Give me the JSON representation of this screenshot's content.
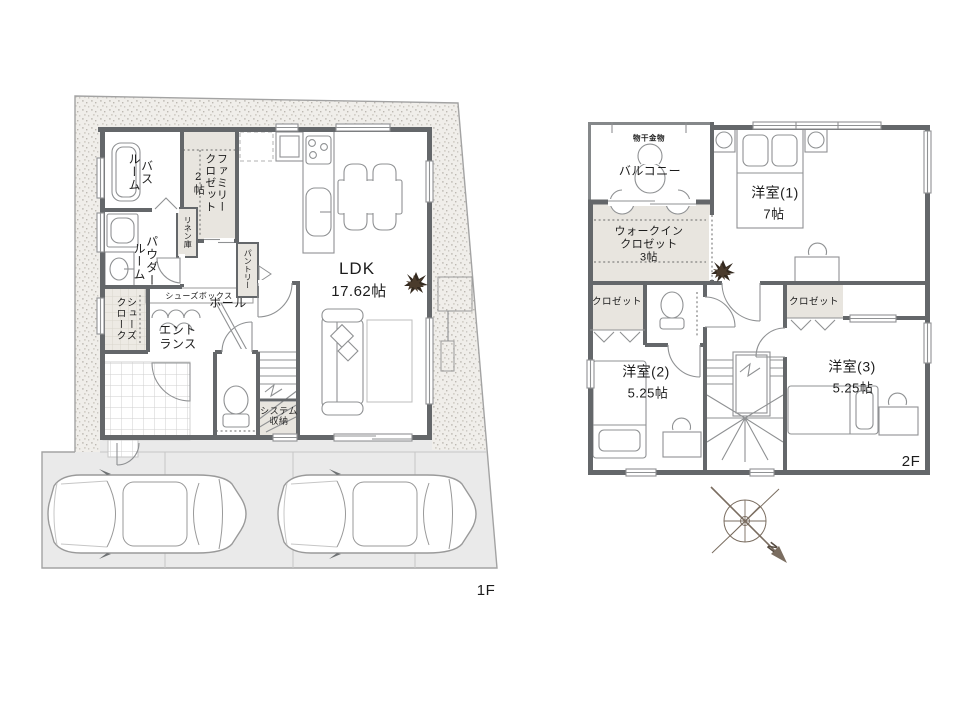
{
  "floor1": {
    "floor_label": "1F",
    "rooms": {
      "bath": "バス\nルーム",
      "family_closet": "ファミリー\nクロゼット\n2帖",
      "linen": "リネン庫",
      "powder": "パウダー\nルーム",
      "pantry": "パントリー",
      "shoes_box": "シューズボックス",
      "shoes_cloak": "シューズ\nクローク",
      "entrance": "エント\nランス",
      "hall": "ホール",
      "ldk_name": "LDK",
      "ldk_size": "17.62帖",
      "system_storage": "システム\n収納"
    }
  },
  "floor2": {
    "floor_label": "2F",
    "rooms": {
      "laundry_hardware": "物干金物",
      "balcony": "バルコニー",
      "room1_name": "洋室(1)",
      "room1_size": "7帖",
      "walk_in_closet": "ウォークイン\nクロゼット\n3帖",
      "closet_left": "クロゼット",
      "closet_right": "クロゼット",
      "room2_name": "洋室(2)",
      "room2_size": "5.25帖",
      "room3_name": "洋室(3)",
      "room3_size": "5.25帖"
    }
  },
  "compass": {
    "north_label": "N"
  },
  "colors": {
    "wall": "#64676a",
    "storage_fill": "#e8e5df",
    "site_hatch_bg": "#f0eeea",
    "site_hatch_dot": "#c6c2bc",
    "parking_fill": "#eaeaea",
    "outline": "#9a9a9a",
    "text": "#1c1c1c",
    "plant": "#33291f",
    "compass": "#7a6d60"
  }
}
